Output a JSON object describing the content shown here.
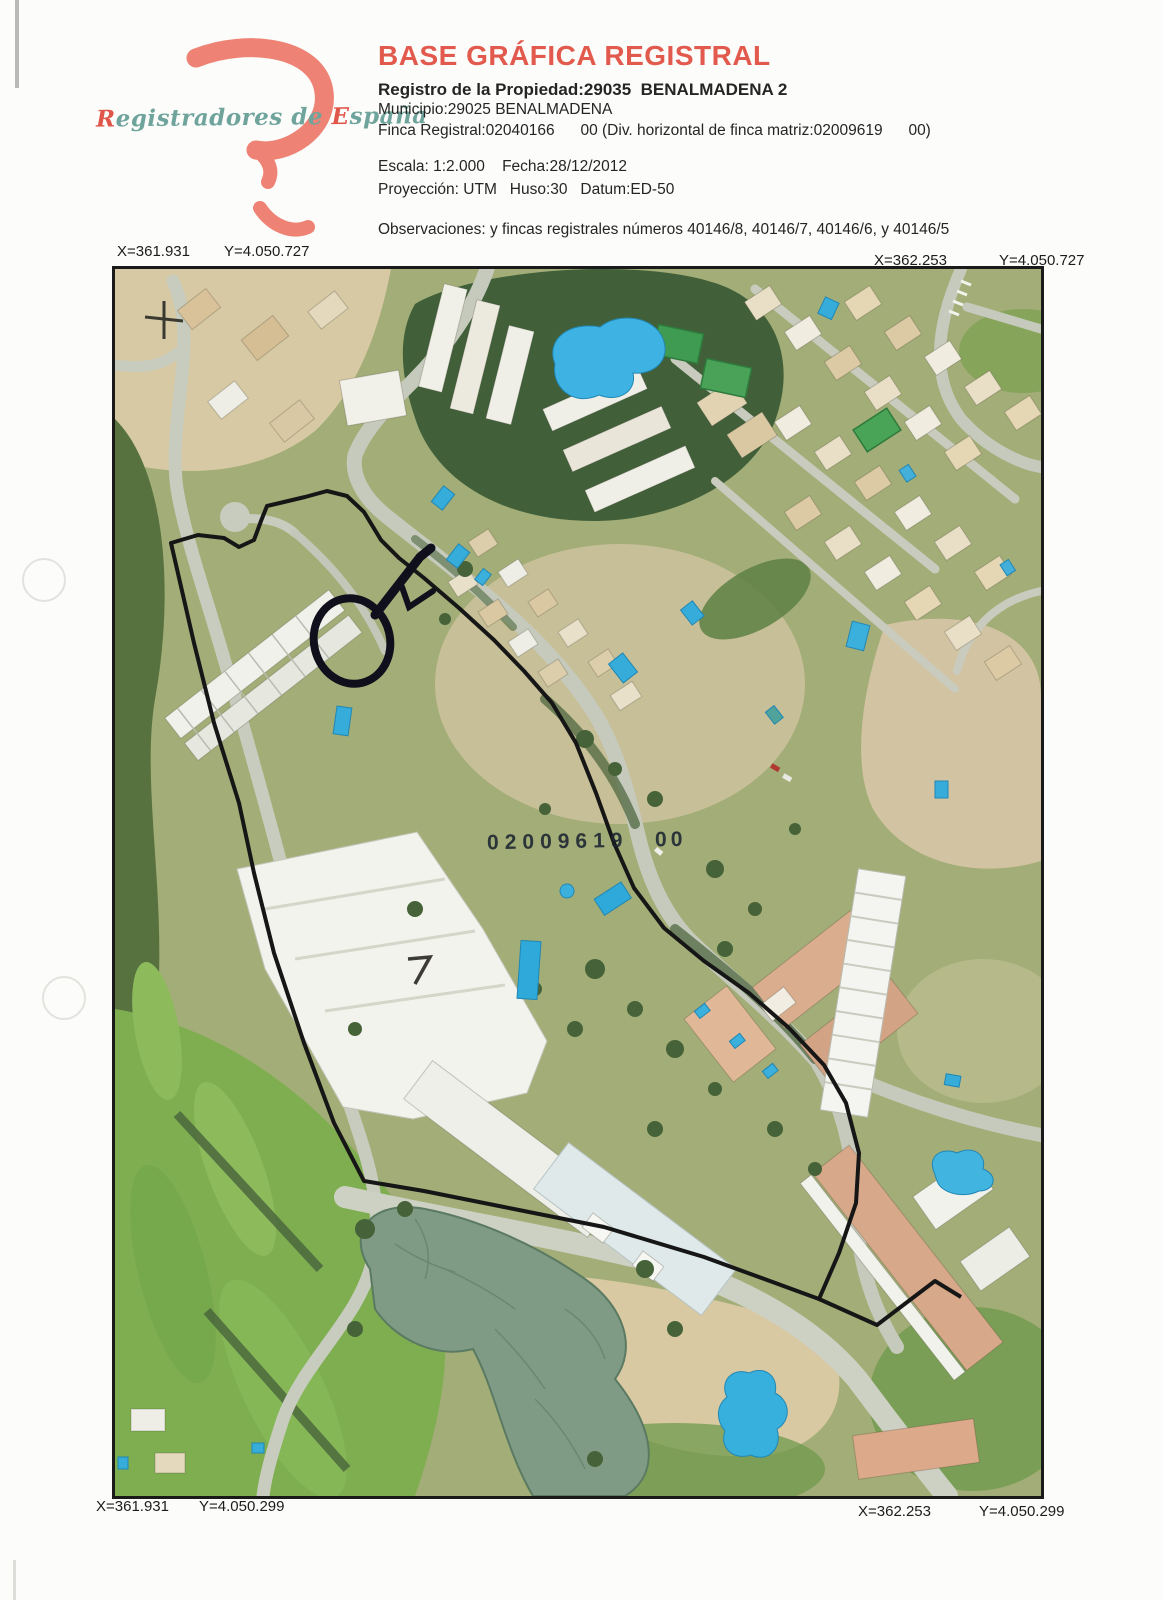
{
  "logo": {
    "caption_cap1": "R",
    "caption_mid": "egistradores de ",
    "caption_cap2": "E",
    "caption_end": "spaña"
  },
  "header": {
    "title": "BASE GRÁFICA REGISTRAL",
    "line_registro": "Registro de la Propiedad:29035  BENALMADENA 2",
    "line_municipio": "Municipio:29025 BENALMADENA",
    "line_finca": "Finca Registral:02040166      00 (Div. horizontal de finca matriz:02009619      00)",
    "line_escala": "Escala: 1:2.000    Fecha:28/12/2012",
    "line_proyeccion": "Proyección: UTM   Huso:30   Datum:ED-50",
    "line_observaciones": "Observaciones: y fincas registrales números 40146/8, 40146/7, 40146/6, y 40146/5"
  },
  "map": {
    "parcel_label": "02009619",
    "parcel_label_suffix": "00",
    "corners": {
      "top_left_x": "X=361.931",
      "top_left_y": "Y=4.050.727",
      "top_right_x": "X=362.253",
      "top_right_y": "Y=4.050.727",
      "bottom_left_x": "X=361.931",
      "bottom_left_y": "Y=4.050.299",
      "bottom_right_x": "X=362.253",
      "bottom_right_y": "Y=4.050.299"
    }
  },
  "colors": {
    "accent_red": "#e25a4d",
    "logo_salmon": "#ee8275",
    "logo_teal": "#6fa49d",
    "pool_blue": "#35acd9",
    "boundary_black": "#161616",
    "road_gray": "#c6cabc",
    "golf_green": "#7fae51"
  }
}
